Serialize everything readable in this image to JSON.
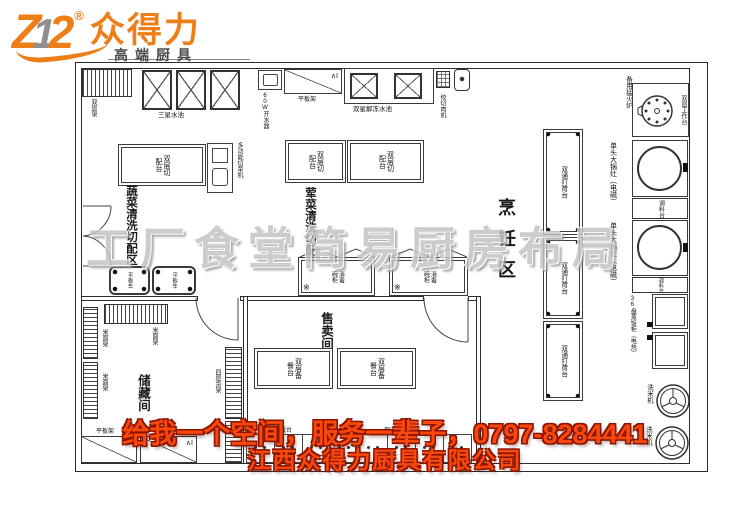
{
  "logo": {
    "z": "Z",
    "one": "1",
    "two": "2",
    "reg": "®",
    "brand": "众得力",
    "tagline": "高端厨具"
  },
  "watermark": "工厂食堂简易厨房布局",
  "banner": {
    "line1": "给我一个空间，服务一辈子，0797-8284441",
    "line2": "江西众得力厨具有限公司"
  },
  "zones": {
    "vegetable": "蔬菜清洗切配区",
    "meat": "荤菜清洗切配区",
    "cooking": "烹饪区",
    "sales": "售卖间",
    "storage": "储藏间"
  },
  "equipment": {
    "double_layer_rack": "双层架",
    "three_star_sink": "三星水池",
    "water_boiler": "60W开水器",
    "flat_rack": "平板架",
    "double_star_sink": "双星解冻水池",
    "meat_grinder": "绞切肉机",
    "double_layer_cutting_table": "双层切配台",
    "multi_function_cutter": "多功能切菜机",
    "flat_cart": "平板车",
    "rice_flour_rack": "米面架",
    "four_layer_rack": "四层货架",
    "sterilizer_cabinet": "消毒碗柜",
    "double_layer_prep_table": "双层备餐台",
    "heated_serving_counter": "保温售饭台",
    "double_pass_prep_table": "双通打荷台",
    "spare_burner": "备用猛火炉",
    "double_layer_work_table": "双层工作台",
    "single_wok_stove": "单头大锅灶（电磁）",
    "spice_table": "调料台",
    "rice_steamer": "36盘蒸饭柜（电热）",
    "rice_washer": "洗米机"
  },
  "marks": {
    "vent": "∧I",
    "star": "※"
  },
  "colors": {
    "brand_orange": "#ee7f18",
    "banner_text": "#f9480e",
    "banner_outline": "#8c1500",
    "watermark_gray": "#c4c4c4",
    "plan_line": "#3a3a3a"
  }
}
